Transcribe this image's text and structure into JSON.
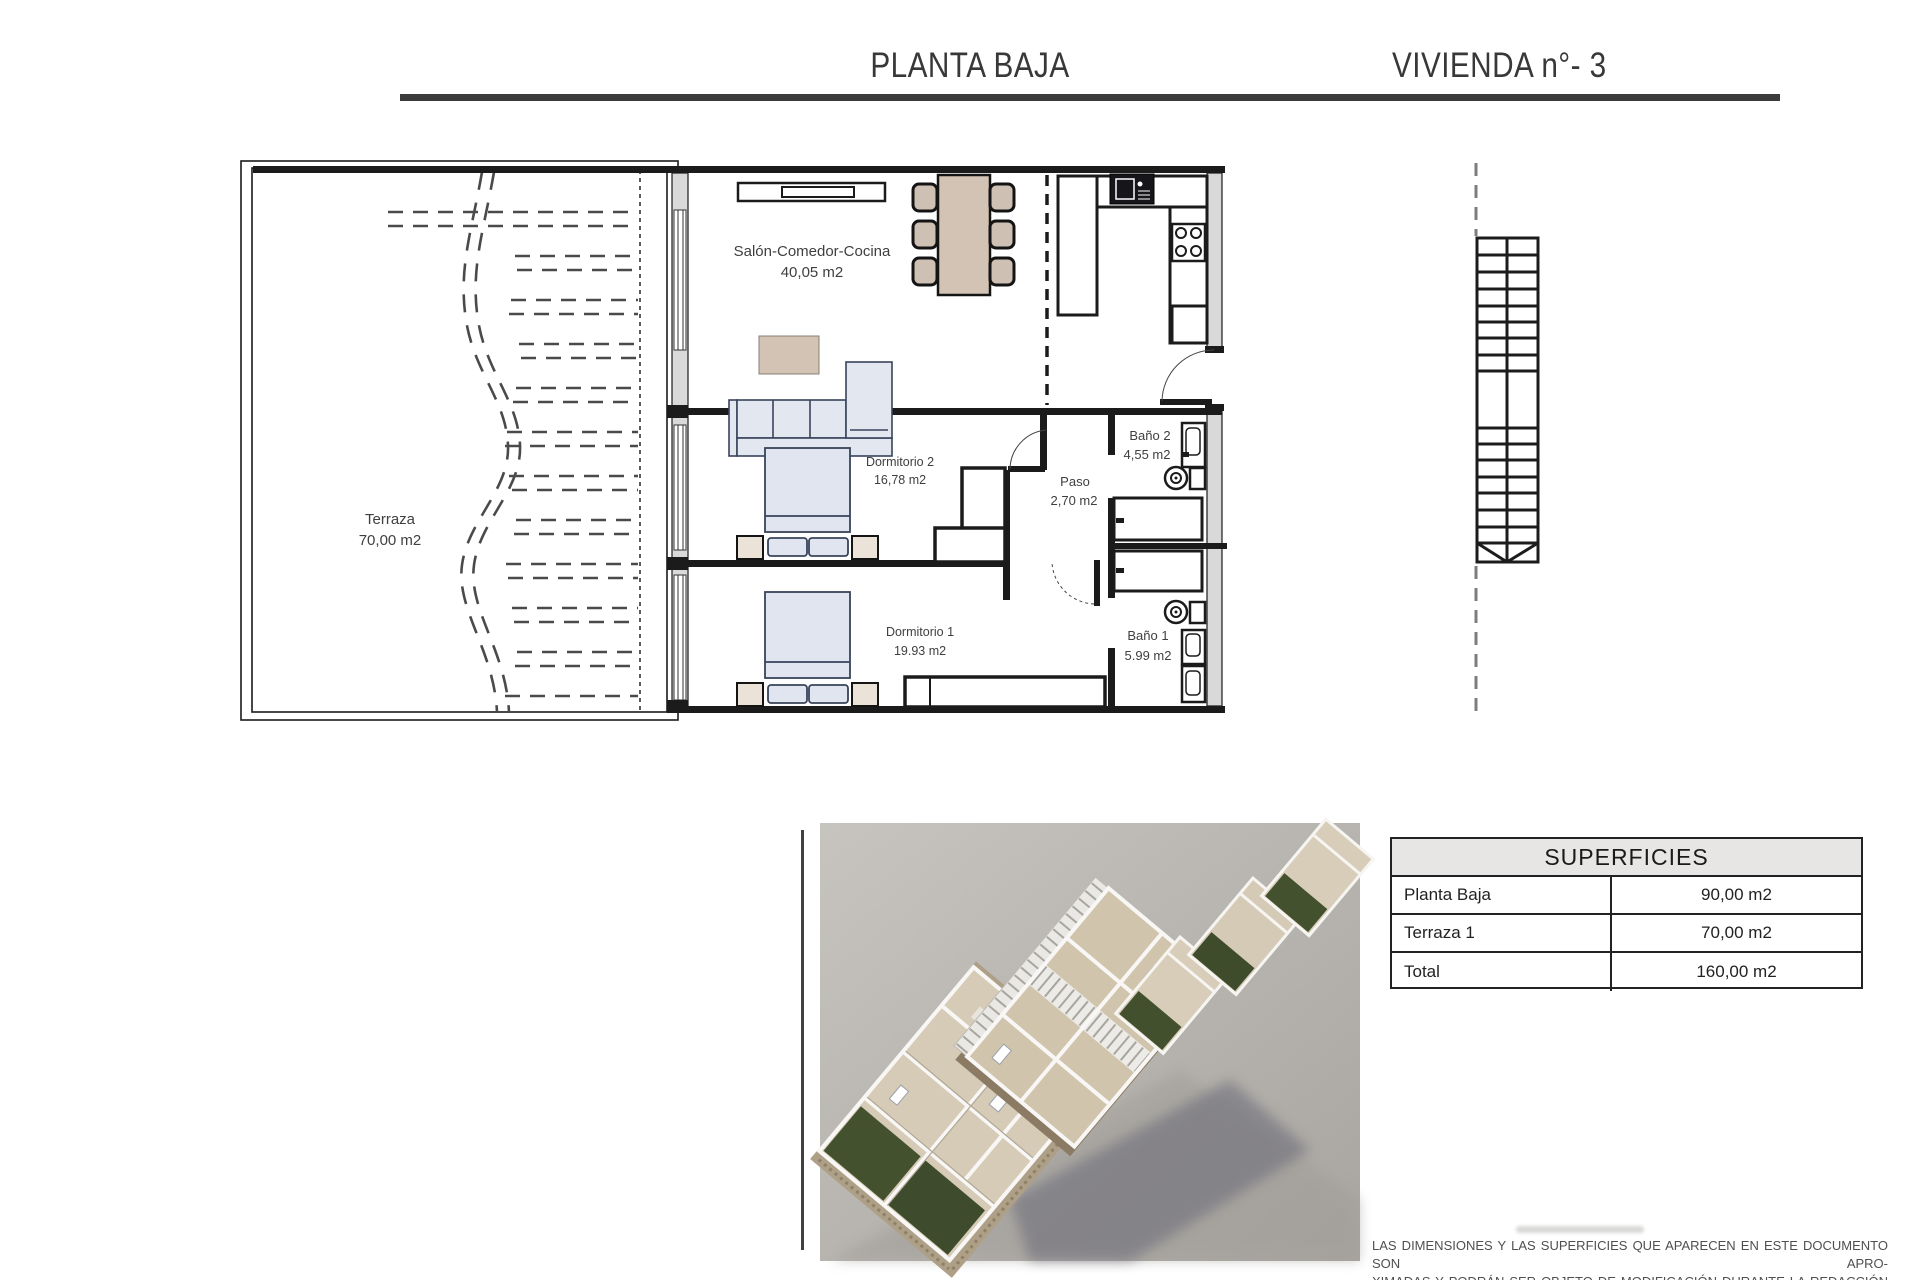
{
  "header": {
    "title_left": "PLANTA BAJA",
    "title_right": "VIVIENDA n°- 3"
  },
  "floor_plan": {
    "rooms": [
      {
        "id": "terraza",
        "name": "Terraza",
        "area": "70,00 m2"
      },
      {
        "id": "salon",
        "name": "Salón-Comedor-Cocina",
        "area": "40,05 m2"
      },
      {
        "id": "dormitorio2",
        "name": "Dormitorio 2",
        "area": "16,78 m2"
      },
      {
        "id": "paso",
        "name": "Paso",
        "area": "2,70 m2"
      },
      {
        "id": "bano2",
        "name": "Baño 2",
        "area": "4,55 m2"
      },
      {
        "id": "dormitorio1",
        "name": "Dormitorio 1",
        "area": "19.93 m2"
      },
      {
        "id": "bano1",
        "name": "Baño 1",
        "area": "5.99 m2"
      }
    ]
  },
  "superficies_table": {
    "title": "SUPERFICIES",
    "rows": [
      {
        "label": "Planta Baja",
        "value": "90,00 m2"
      },
      {
        "label": "Terraza 1",
        "value": "70,00 m2"
      },
      {
        "label": "Total",
        "value": "160,00 m2"
      }
    ]
  },
  "disclaimer": {
    "lines": [
      "LAS DIMENSIONES Y LAS SUPERFICIES QUE APARECEN EN ESTE DOCUMENTO SON APRO-",
      "XIMADAS Y PODRÁN SER OBJETO DE MODIFICACIÓN DURANTE LA REDACCIÓN DE LOS",
      "PROYECTOS BÁSICO Y DE EJECUCIÓN."
    ]
  },
  "colors": {
    "wall": "#1b1b1b",
    "title": "#383838",
    "furniture_tan": "#d3c3b5",
    "furniture_blue": "#e0e5ef",
    "nightstand_beige": "#ebe3d8",
    "table_header_bg": "#e8e6e4",
    "garden_green": "#42502e",
    "render_background": "#b5b2ad"
  }
}
